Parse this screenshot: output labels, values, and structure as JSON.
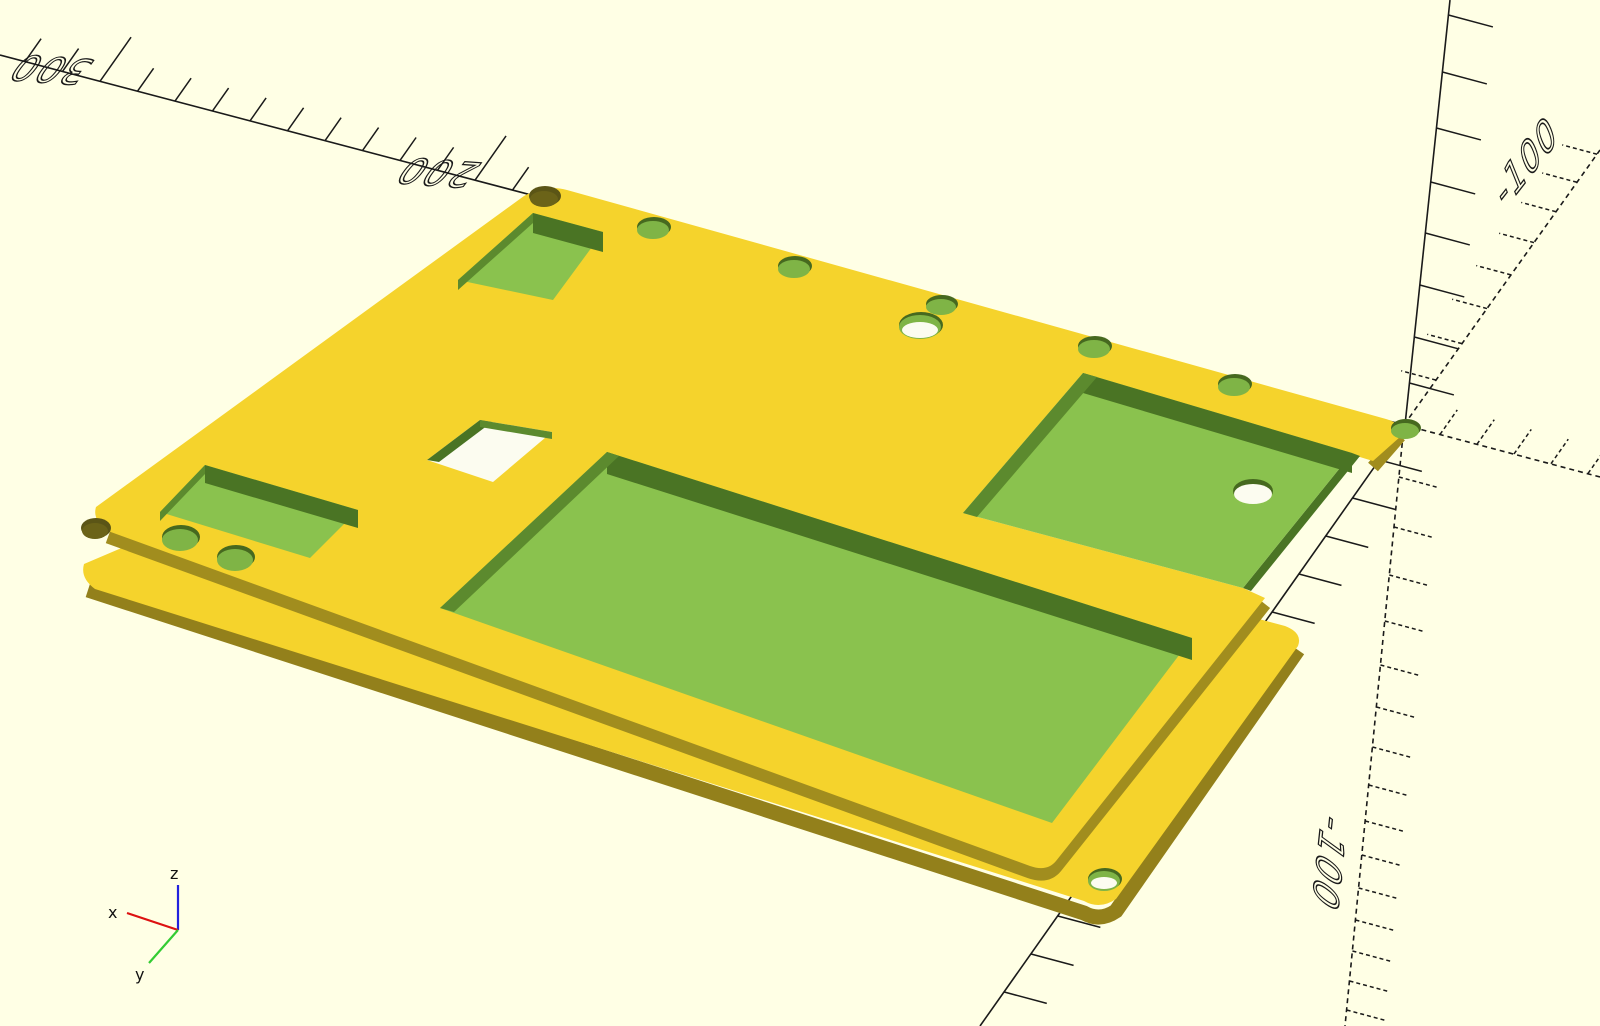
{
  "viewport": {
    "background": "#FFFFE5",
    "ruler_color": "#1a1a1a"
  },
  "axis_labels": {
    "x_300": "300",
    "x_200": "200",
    "y_neg_100": "-100",
    "z_neg_100": "-100"
  },
  "axis_indicator": {
    "x_label": "x",
    "y_label": "y",
    "z_label": "z",
    "x_color": "#dd1111",
    "y_color": "#33cc33",
    "z_color": "#2222dd"
  },
  "model": {
    "plate_top_color": "#F5D32C",
    "plate_side_color": "#A18D1E",
    "plate_side_dark": "#93801B",
    "pocket_floor_color": "#8AC24E",
    "pocket_wall_dark": "#4A7424",
    "pocket_wall_light": "#5C8A2E",
    "hole_green": "#7FB446",
    "hole_rim": "#46691F",
    "hole_dark": "#5B5516",
    "hole_dark_inner": "#6B6318",
    "through_color": "#FCFCF0"
  }
}
